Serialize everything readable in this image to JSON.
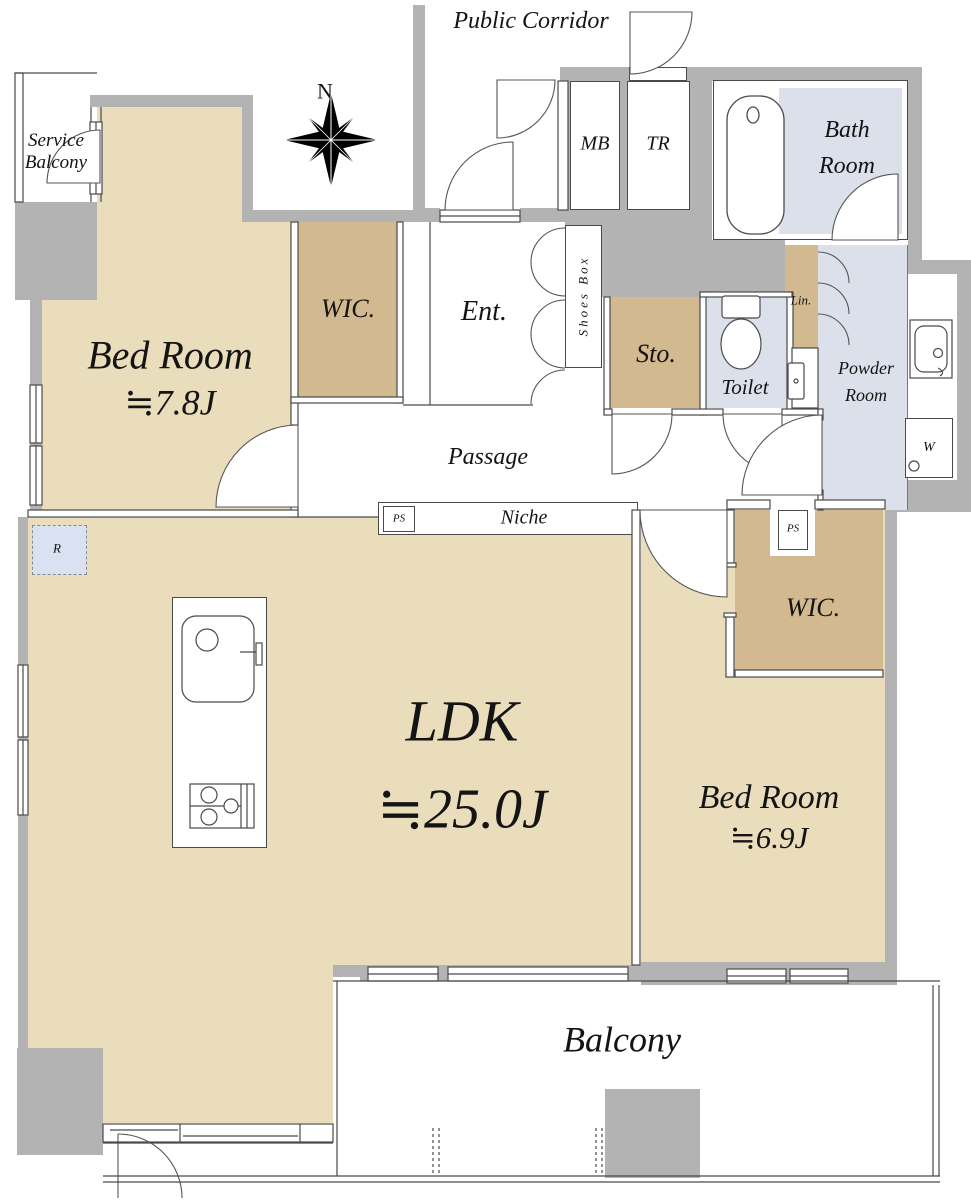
{
  "plan": {
    "corridor": "Public Corridor",
    "compass": "N",
    "service_balcony": {
      "line1": "Service",
      "line2": "Balcony"
    },
    "mb": "MB",
    "tr": "TR",
    "bath": {
      "line1": "Bath",
      "line2": "Room"
    },
    "bed_room_1": {
      "name": "Bed Room",
      "size": "≒7.8J"
    },
    "wic_1": "WIC.",
    "ent": "Ent.",
    "shoes_box": "Shoes Box",
    "sto": "Sto.",
    "toilet": "Toilet",
    "lin": "Lin.",
    "powder": {
      "line1": "Powder",
      "line2": "Room"
    },
    "passage": "Passage",
    "niche": "Niche",
    "ps_left": "PS",
    "ps_right": "PS",
    "ldk": {
      "name": "LDK",
      "size": "≒25.0J"
    },
    "bed_room_2": {
      "name": "Bed Room",
      "size": "≒6.9J"
    },
    "wic_2": "WIC.",
    "balcony": "Balcony",
    "refrigerator": "R",
    "washer": "W"
  },
  "colors": {
    "floor_tan": "#EADDBC",
    "closet_tan": "#D2B990",
    "wet_blue": "#DCE0EB",
    "wall_gray": "#B3B3B3",
    "line": "#4a4a4a",
    "fridge_blue": "#DAE1F0"
  }
}
